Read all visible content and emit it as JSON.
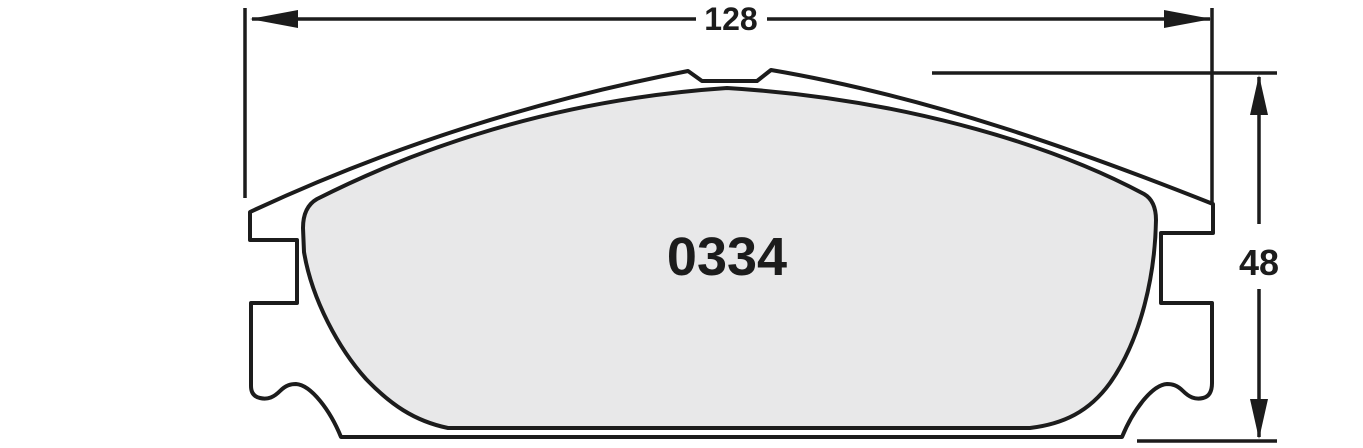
{
  "diagram": {
    "title": "brake-pad-technical-drawing",
    "part_number": "0334",
    "dimensions": {
      "width_value": "128",
      "height_value": "48"
    },
    "colors": {
      "line": "#1c1c1c",
      "plate_fill": "#ffffff",
      "friction_fill": "#e8e8e9",
      "background": "#ffffff"
    },
    "canvas": {
      "width": 1363,
      "height": 448
    },
    "shapes": [
      {
        "type": "path",
        "name": "backing-plate-outline",
        "d": "M 250 212 C 400 142 545 99 688 71 L 702 81 L 757 81 L 771 70 C 930 97 1082 152 1213 204 L 1213 233 L 1161 233 L 1161 303 L 1212 303 L 1212 383 Q 1212 396 1203 398 C 1195 400 1189 397 1183 391 C 1177 385 1172 384 1167 384 C 1152 385 1133 410 1122 437 L 341 437 C 330 410 311 385 296 384 C 291 384 286 385 280 391 C 274 397 268 400 260 398 Q 251 396 251 386 L 251 303 L 297 303 L 297 240 L 250 240 Z",
        "fill": "#ffffff",
        "stroke": "#1c1c1c",
        "strokeWidth": 4
      },
      {
        "type": "path",
        "name": "friction-material",
        "d": "M 317 199 C 430 142 565 99 727 88 C 893 98 1045 141 1144 194 Q 1156 201 1156 220 C 1155 276 1141 339 1110 383 C 1089 412 1063 424 1030 428 L 448 428 C 414 421 390 404 366 379 C 339 349 312 300 304 252 L 303 228 Q 303 207 317 199 Z",
        "fill": "#e8e8e9",
        "stroke": "#1c1c1c",
        "strokeWidth": 4
      },
      {
        "type": "line",
        "name": "extension-line-width-left",
        "x1": 245,
        "y1": 8,
        "x2": 245,
        "y2": 198,
        "strokeWidth": 3.5
      },
      {
        "type": "line",
        "name": "extension-line-width-right",
        "x1": 1212,
        "y1": 8,
        "x2": 1212,
        "y2": 202,
        "strokeWidth": 3.5
      },
      {
        "type": "line",
        "name": "dimension-line-width-left-segment",
        "x1": 252,
        "y1": 19,
        "x2": 696,
        "y2": 19,
        "strokeWidth": 3.5
      },
      {
        "type": "line",
        "name": "dimension-line-width-right-segment",
        "x1": 767,
        "y1": 19,
        "x2": 1210,
        "y2": 19,
        "strokeWidth": 3.5
      },
      {
        "type": "polygon",
        "name": "arrowhead-width-left",
        "points": "250,19 298,10 298,28"
      },
      {
        "type": "polygon",
        "name": "arrowhead-width-right",
        "points": "1212,19 1164,10 1164,28"
      },
      {
        "type": "line",
        "name": "extension-line-height-top",
        "x1": 932,
        "y1": 73,
        "x2": 1277,
        "y2": 73,
        "strokeWidth": 3.5
      },
      {
        "type": "line",
        "name": "extension-line-height-bottom",
        "x1": 1137,
        "y1": 441,
        "x2": 1277,
        "y2": 441,
        "strokeWidth": 3.5
      },
      {
        "type": "line",
        "name": "dimension-line-height-top-segment",
        "x1": 1259,
        "y1": 77,
        "x2": 1259,
        "y2": 224,
        "strokeWidth": 3.5
      },
      {
        "type": "line",
        "name": "dimension-line-height-bottom-segment",
        "x1": 1259,
        "y1": 289,
        "x2": 1259,
        "y2": 437,
        "strokeWidth": 3.5
      },
      {
        "type": "polygon",
        "name": "arrowhead-height-top",
        "points": "1259,75 1250,115 1268,115"
      },
      {
        "type": "polygon",
        "name": "arrowhead-height-bottom",
        "points": "1259,439 1250,399 1268,399"
      }
    ],
    "labels": [
      {
        "name": "width-dimension-label",
        "text": "128",
        "x": 731,
        "y": 30,
        "size": 32,
        "bind": "diagram.labels.0.text"
      },
      {
        "name": "height-dimension-label",
        "text": "48",
        "x": 1259,
        "y": 275,
        "size": 36,
        "bind": "diagram.labels.1.text"
      },
      {
        "name": "part-number-label",
        "text": "0334",
        "x": 727,
        "y": 275,
        "size": 54,
        "bind": "diagram.labels.2.text"
      }
    ]
  }
}
